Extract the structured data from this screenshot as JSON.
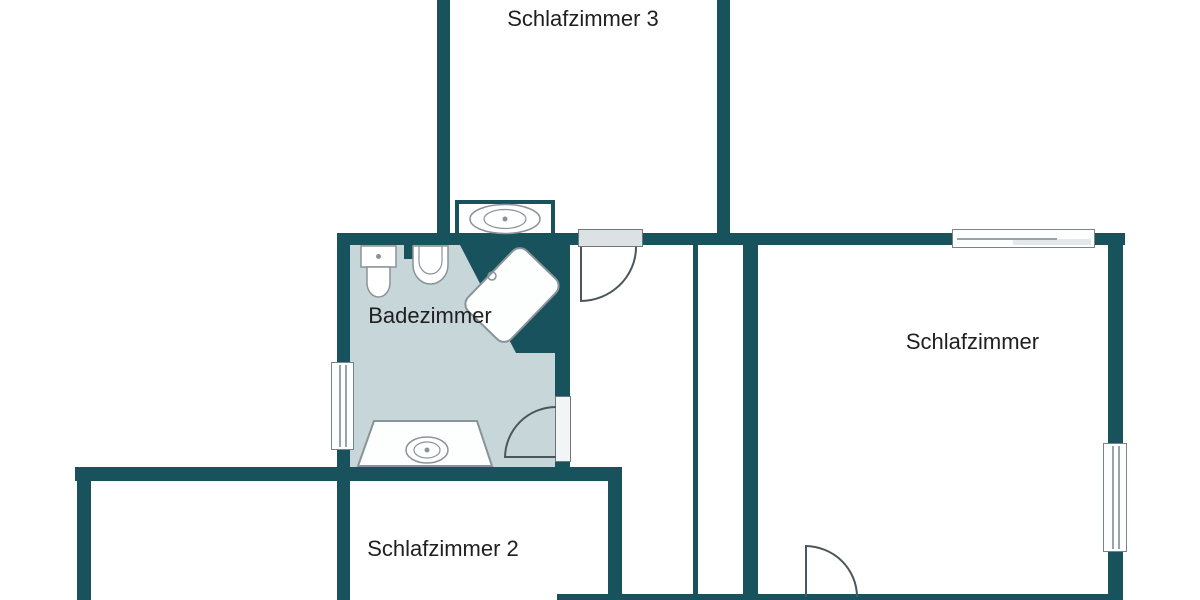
{
  "floorplan": {
    "rooms": [
      {
        "id": "schlafzimmer-3",
        "label": "Schlafzimmer 3"
      },
      {
        "id": "badezimmer",
        "label": "Badezimmer"
      },
      {
        "id": "schlafzimmer",
        "label": "Schlafzimmer"
      },
      {
        "id": "schlafzimmer-2",
        "label": "Schlafzimmer 2"
      }
    ],
    "fixtures": [
      "washbasin",
      "toilet",
      "bidet",
      "shower",
      "bathtub"
    ],
    "openings": {
      "doors": [
        "hall-door-top",
        "bathroom-door-right",
        "bedroom-door-bottom"
      ],
      "windows": [
        "bathroom-window-left",
        "bedroom-window-top",
        "bedroom-window-right"
      ]
    },
    "colors": {
      "wall": "#18525c",
      "bathroom_floor": "#c7d6d9",
      "fixture_outline": "#8a9498",
      "door_arc": "#4a565c",
      "door_panel": "#dce1e4",
      "window_frame": "#79838a",
      "text": "#1f1f1f",
      "background": "#ffffff"
    }
  }
}
